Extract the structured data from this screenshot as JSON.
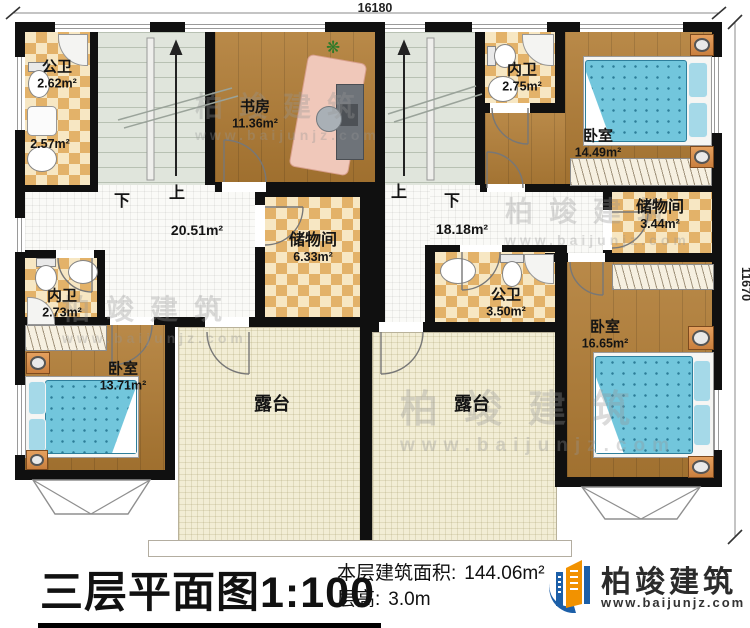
{
  "dimensions": {
    "top": "16180",
    "right": "11670"
  },
  "rooms": {
    "bath_tl": {
      "name": "公卫",
      "area": "2.62m²",
      "area2": "2.57m²"
    },
    "study": {
      "name": "书房",
      "area": "11.36m²"
    },
    "bath_tr": {
      "name": "内卫",
      "area": "2.75m²"
    },
    "bed_tr": {
      "name": "卧室",
      "area": "14.49m²"
    },
    "hall_left": {
      "area": "20.51m²"
    },
    "hall_right": {
      "area": "18.18m²"
    },
    "storage_left": {
      "name": "储物间",
      "area": "6.33m²"
    },
    "storage_right": {
      "name": "储物间",
      "area": "3.44m²"
    },
    "bath_bl": {
      "name": "内卫",
      "area": "2.73m²"
    },
    "bed_bl": {
      "name": "卧室",
      "area": "13.71m²"
    },
    "bath_br": {
      "name": "公卫",
      "area": "3.50m²"
    },
    "bed_br": {
      "name": "卧室",
      "area": "16.65m²"
    },
    "terrace_left": {
      "name": "露台"
    },
    "terrace_right": {
      "name": "露台"
    }
  },
  "stairs": {
    "left": {
      "down": "下",
      "up": "上"
    },
    "right": {
      "up": "上",
      "down": "下"
    }
  },
  "titleblock": {
    "title": "三层平面图",
    "scale": "1:100",
    "area_label": "本层建筑面积:",
    "area_value": "144.06m²",
    "height_label": "层高:",
    "height_value": "3.0m"
  },
  "branding": {
    "name": "柏竣建筑",
    "website": "www.baijunjz.com"
  },
  "watermark": {
    "name": "柏竣建筑",
    "website": "www.baijunjz.com"
  },
  "colors": {
    "wall": "#101010",
    "wood": "#b17c34",
    "checker": "#e3b269",
    "stairs": "#e0e5dc",
    "terrace": "#f2edd5",
    "bed": "#72c6dc",
    "logo_blue": "#1c5fa8",
    "logo_orange": "#f29200"
  }
}
